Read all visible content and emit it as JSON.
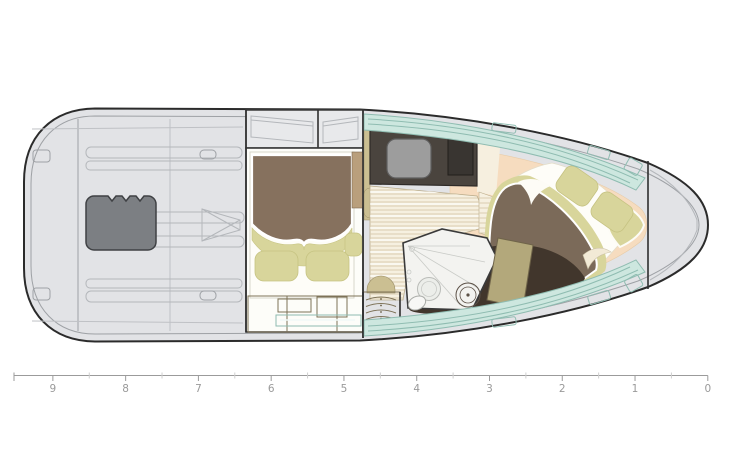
{
  "diagram": {
    "kind": "boat-deck-floor-plan"
  },
  "palette": {
    "hull": "#e2e3e6",
    "outline": "#2b2b2b",
    "engine": "#7c7f83",
    "window": "#e8e9eb",
    "cabinWhite": "#fdfdf9",
    "platformWhite": "#fefdf8",
    "bedBrown": "#86715e",
    "bowBedBrown": "#7b6a59",
    "khaki": "#d8d59b",
    "cabinetTan": "#b2a67c",
    "drawerTan": "#c3b88d",
    "darkTan": "#a3976c",
    "doorTan": "#b3a87b",
    "tealShelf": "#cfe9e1",
    "teal": "#cde7df",
    "counterDark": "#4a443e",
    "sinkGray": "#9d9d9d",
    "stoveDark": "#393531",
    "wood": "#f6f0e0",
    "cream": "#f6efdf",
    "headWhite": "#f3f3f0",
    "headFloor": "#41362c",
    "peach": "#f6dcbf",
    "curl": "#f2ead6"
  },
  "ruler": {
    "labels": [
      "9",
      "8",
      "7",
      "6",
      "5",
      "4",
      "3",
      "2",
      "1",
      "0"
    ]
  }
}
